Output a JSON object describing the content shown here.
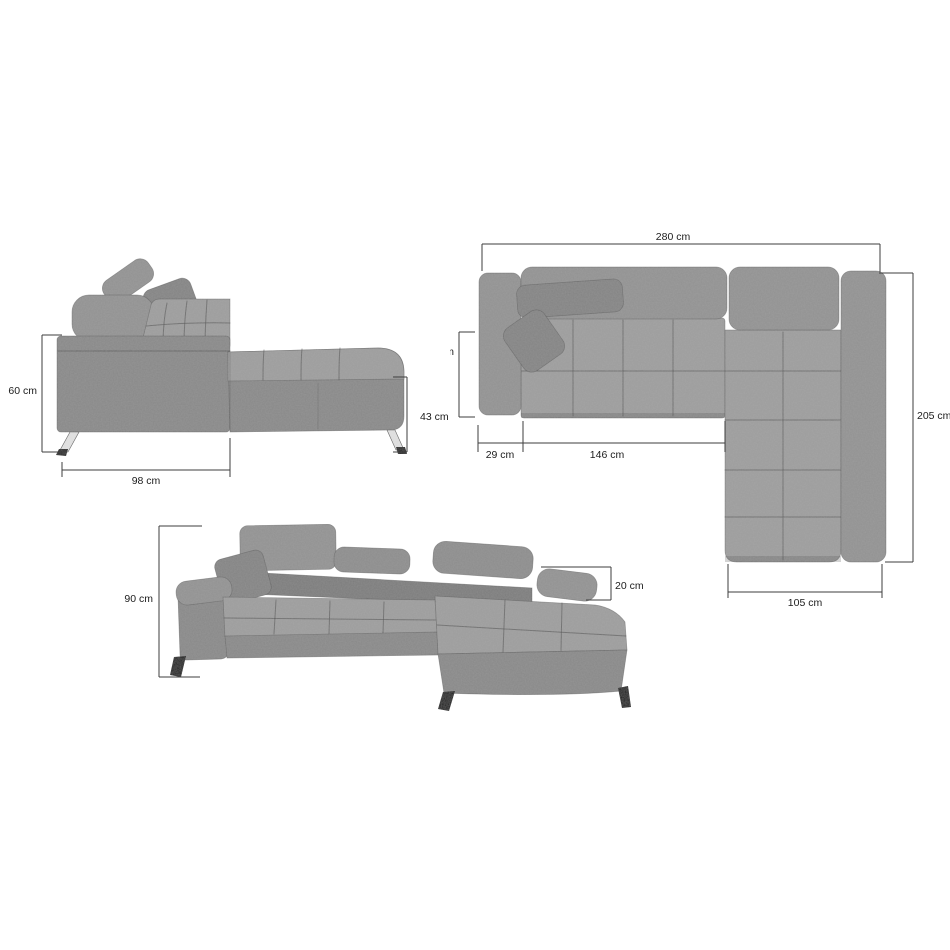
{
  "colors": {
    "background": "#ffffff",
    "fabric": "#929292",
    "fabric_light": "#9d9d9d",
    "fabric_shadow": "#6e6e6e",
    "leg_chrome": "#e2e2e2",
    "leg_black": "#141414",
    "dimension_line": "#3d3d3d",
    "label_text": "#1c1c1c"
  },
  "side_view": {
    "height": "60 cm",
    "base_length": "98 cm",
    "chaise_height": "43 cm"
  },
  "top_view": {
    "total_width": "280 cm",
    "total_depth": "205 cm",
    "seat_depth": "60 cm",
    "armrest_width": "29 cm",
    "seat_width": "146 cm",
    "chaise_width": "105 cm"
  },
  "front_view": {
    "total_height": "90 cm",
    "armrest_height": "20 cm"
  }
}
